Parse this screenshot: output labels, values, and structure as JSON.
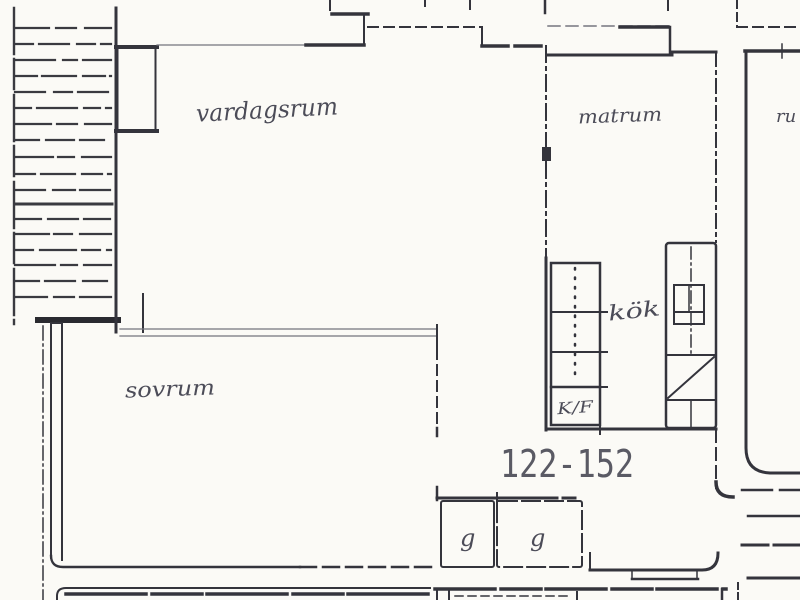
{
  "plan": {
    "unit_number": "122-152",
    "rooms": {
      "living_room": "vardagsrum",
      "dining_room": "matrum",
      "kitchen": "kök",
      "bedroom": "sovrum",
      "wardrobe_left": "g",
      "wardrobe_right": "g",
      "neighbor_room_partial": "ru"
    },
    "appliance_labels": {
      "fridge_freezer": "K/F"
    },
    "colors": {
      "background": "#fbfaf6",
      "ink": "#34343c",
      "ink_faint": "#74747e",
      "handwriting": "#4c4c58",
      "unit_number_ink": "#5a5a64"
    }
  }
}
